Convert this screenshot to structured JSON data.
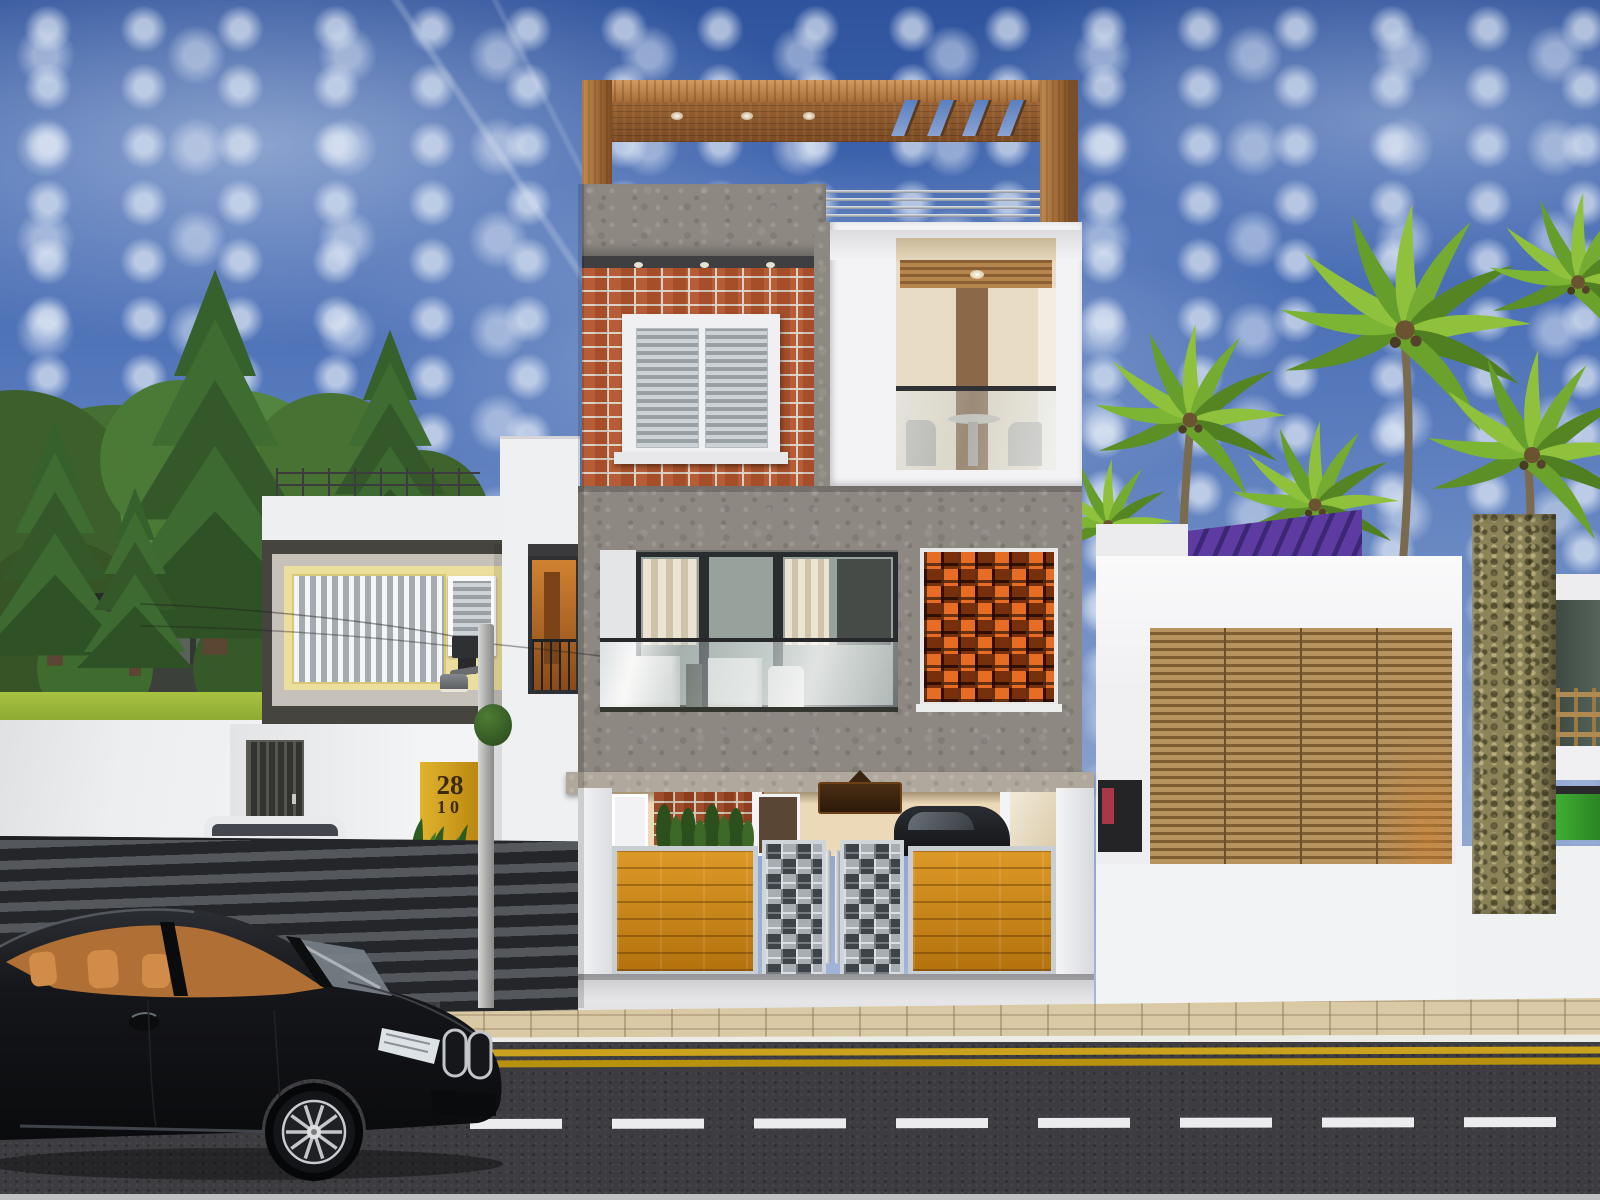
{
  "scene": {
    "title": "Modern three-storey house — front elevation 3D render",
    "setting": "Daytime street view, blue sky with scattered clouds, conifer trees left, coconut palms right, black sedan parked at kerb",
    "house_number": {
      "line1": "28",
      "line2": "10"
    },
    "road_markings": {
      "center_line": "white dashes",
      "kerb_line": "double yellow"
    }
  },
  "colors": {
    "sky_top": "#2f539c",
    "sky_horizon": "#c3cde0",
    "cloud": "#dde6f2",
    "concrete_grey": "#8e8882",
    "brick_orange": "#b2542c",
    "mortar": "#d9cfc2",
    "pergola_wood": "#b97c46",
    "jali_orange": "#e2601a",
    "gate_orange": "#d08a1c",
    "metal_gate_grid": "#c9ced3",
    "white_wall": "#f2f2f4",
    "beige_wall": "#ecd9b8",
    "yellow_accent_band": "#ecdf9e",
    "door_yellow": "#d8a826",
    "louver_wood": "#b6935f",
    "stone_pillar": "#8c8458",
    "solar_purple": "#5d3ba0",
    "grass": "#9ab838",
    "palm_green": "#8fc13c",
    "conifer_green": "#3a6130",
    "road_asphalt": "#3c3c41",
    "lane_marking_white": "#ececee",
    "kerb_yellow": "#caa21d",
    "sidewalk_paver": "#d9c9a4",
    "car_body": "#121316",
    "car_interior": "#c07a3c",
    "balcony_glass": "#98a29c",
    "dark_trim": "#46443f"
  }
}
